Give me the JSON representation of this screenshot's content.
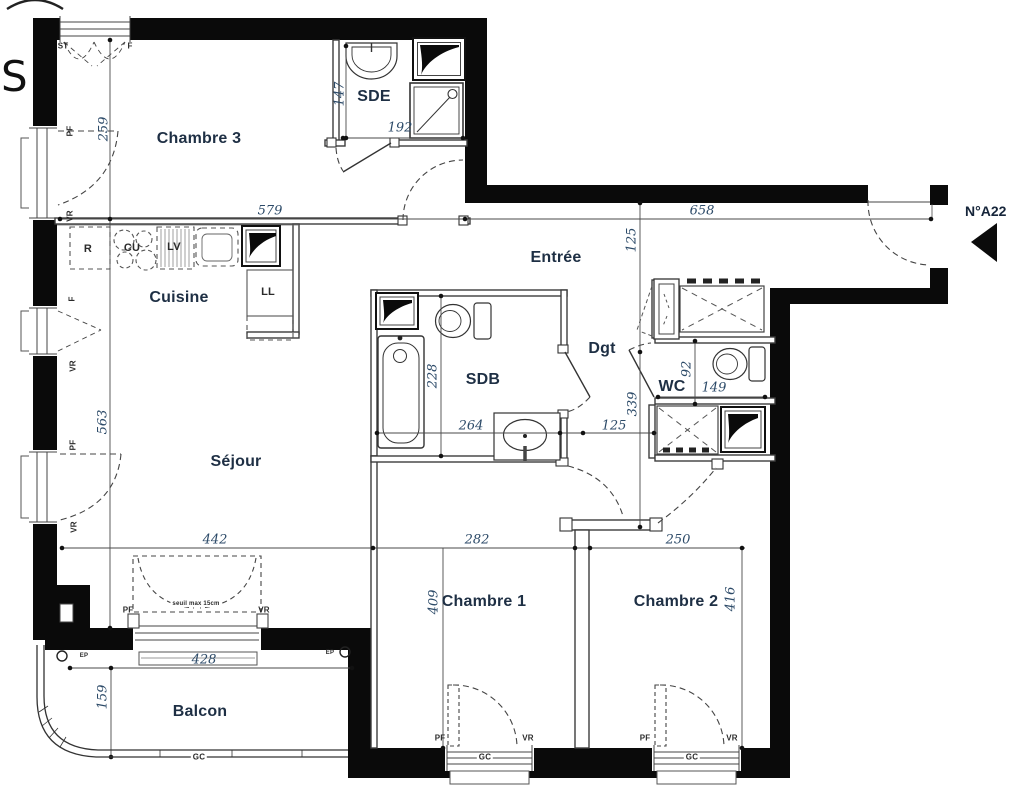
{
  "plan": {
    "unit_label": "N°A22",
    "compass_letter": "S",
    "colors": {
      "wall": "#0a0a0a",
      "line": "#3d3d3d",
      "label_navy": "#1e2f44",
      "dimension_navy": "#2c4a68"
    },
    "rooms": [
      {
        "label": "Chambre 3",
        "x": 199,
        "y": 139
      },
      {
        "label": "SDE",
        "x": 374,
        "y": 97
      },
      {
        "label": "Entrée",
        "x": 556,
        "y": 258
      },
      {
        "label": "Cuisine",
        "x": 179,
        "y": 298
      },
      {
        "label": "SDB",
        "x": 483,
        "y": 380
      },
      {
        "label": "Dgt",
        "x": 602,
        "y": 349
      },
      {
        "label": "WC",
        "x": 672,
        "y": 387
      },
      {
        "label": "Séjour",
        "x": 236,
        "y": 462
      },
      {
        "label": "Chambre 1",
        "x": 484,
        "y": 602
      },
      {
        "label": "Chambre 2",
        "x": 676,
        "y": 602
      },
      {
        "label": "Balcon",
        "x": 200,
        "y": 712
      }
    ],
    "dimensions": [
      {
        "value": "579",
        "x": 270,
        "y": 211,
        "rot": 0
      },
      {
        "value": "658",
        "x": 702,
        "y": 211,
        "rot": 0
      },
      {
        "value": "147",
        "x": 340,
        "y": 94,
        "rot": -90
      },
      {
        "value": "192",
        "x": 400,
        "y": 128,
        "rot": 0
      },
      {
        "value": "259",
        "x": 104,
        "y": 129,
        "rot": -90
      },
      {
        "value": "125",
        "x": 632,
        "y": 240,
        "rot": -90
      },
      {
        "value": "228",
        "x": 433,
        "y": 376,
        "rot": -90
      },
      {
        "value": "264",
        "x": 471,
        "y": 426,
        "rot": 0
      },
      {
        "value": "125",
        "x": 614,
        "y": 426,
        "rot": 0
      },
      {
        "value": "92",
        "x": 687,
        "y": 369,
        "rot": -90
      },
      {
        "value": "149",
        "x": 714,
        "y": 388,
        "rot": 0
      },
      {
        "value": "339",
        "x": 633,
        "y": 404,
        "rot": -90
      },
      {
        "value": "563",
        "x": 103,
        "y": 422,
        "rot": -90
      },
      {
        "value": "442",
        "x": 215,
        "y": 540,
        "rot": 0
      },
      {
        "value": "282",
        "x": 477,
        "y": 540,
        "rot": 0
      },
      {
        "value": "250",
        "x": 678,
        "y": 540,
        "rot": 0
      },
      {
        "value": "409",
        "x": 434,
        "y": 602,
        "rot": -90
      },
      {
        "value": "416",
        "x": 731,
        "y": 599,
        "rot": -90
      },
      {
        "value": "428",
        "x": 204,
        "y": 660,
        "rot": 0
      },
      {
        "value": "159",
        "x": 103,
        "y": 697,
        "rot": -90
      }
    ],
    "small_labels": [
      {
        "text": "ST",
        "x": 63,
        "y": 46,
        "rot": 0,
        "size": 8
      },
      {
        "text": "F",
        "x": 130,
        "y": 46,
        "rot": 0,
        "size": 8
      },
      {
        "text": "PF",
        "x": 70,
        "y": 131,
        "rot": -90,
        "size": 8
      },
      {
        "text": "VR",
        "x": 70,
        "y": 216,
        "rot": -90,
        "size": 8
      },
      {
        "text": "F",
        "x": 72,
        "y": 299,
        "rot": -90,
        "size": 8
      },
      {
        "text": "VR",
        "x": 73,
        "y": 366,
        "rot": -90,
        "size": 8
      },
      {
        "text": "PF",
        "x": 73,
        "y": 445,
        "rot": -90,
        "size": 8
      },
      {
        "text": "VR",
        "x": 74,
        "y": 527,
        "rot": -90,
        "size": 8
      },
      {
        "text": "R",
        "x": 88,
        "y": 249,
        "rot": 0,
        "size": 11
      },
      {
        "text": "CU",
        "x": 132,
        "y": 248,
        "rot": 0,
        "size": 11
      },
      {
        "text": "LV",
        "x": 174,
        "y": 247,
        "rot": 0,
        "size": 11
      },
      {
        "text": "LL",
        "x": 268,
        "y": 292,
        "rot": 0,
        "size": 11
      },
      {
        "text": "PF",
        "x": 128,
        "y": 610,
        "rot": 0,
        "size": 8
      },
      {
        "text": "VR",
        "x": 264,
        "y": 610,
        "rot": 0,
        "size": 8
      },
      {
        "text": "seuil max 15cm",
        "x": 196,
        "y": 604,
        "rot": 0,
        "size": 6,
        "bg": true
      },
      {
        "text": "EP",
        "x": 84,
        "y": 656,
        "rot": 0,
        "size": 6
      },
      {
        "text": "EP",
        "x": 330,
        "y": 653,
        "rot": 0,
        "size": 6
      },
      {
        "text": "GC",
        "x": 199,
        "y": 757,
        "rot": 0,
        "size": 8,
        "bg": true
      },
      {
        "text": "GC",
        "x": 485,
        "y": 757,
        "rot": 0,
        "size": 8,
        "bg": true
      },
      {
        "text": "GC",
        "x": 692,
        "y": 757,
        "rot": 0,
        "size": 8,
        "bg": true
      },
      {
        "text": "PF",
        "x": 440,
        "y": 738,
        "rot": 0,
        "size": 8
      },
      {
        "text": "VR",
        "x": 528,
        "y": 738,
        "rot": 0,
        "size": 8
      },
      {
        "text": "PF",
        "x": 645,
        "y": 738,
        "rot": 0,
        "size": 8
      },
      {
        "text": "VR",
        "x": 732,
        "y": 738,
        "rot": 0,
        "size": 8
      }
    ]
  }
}
